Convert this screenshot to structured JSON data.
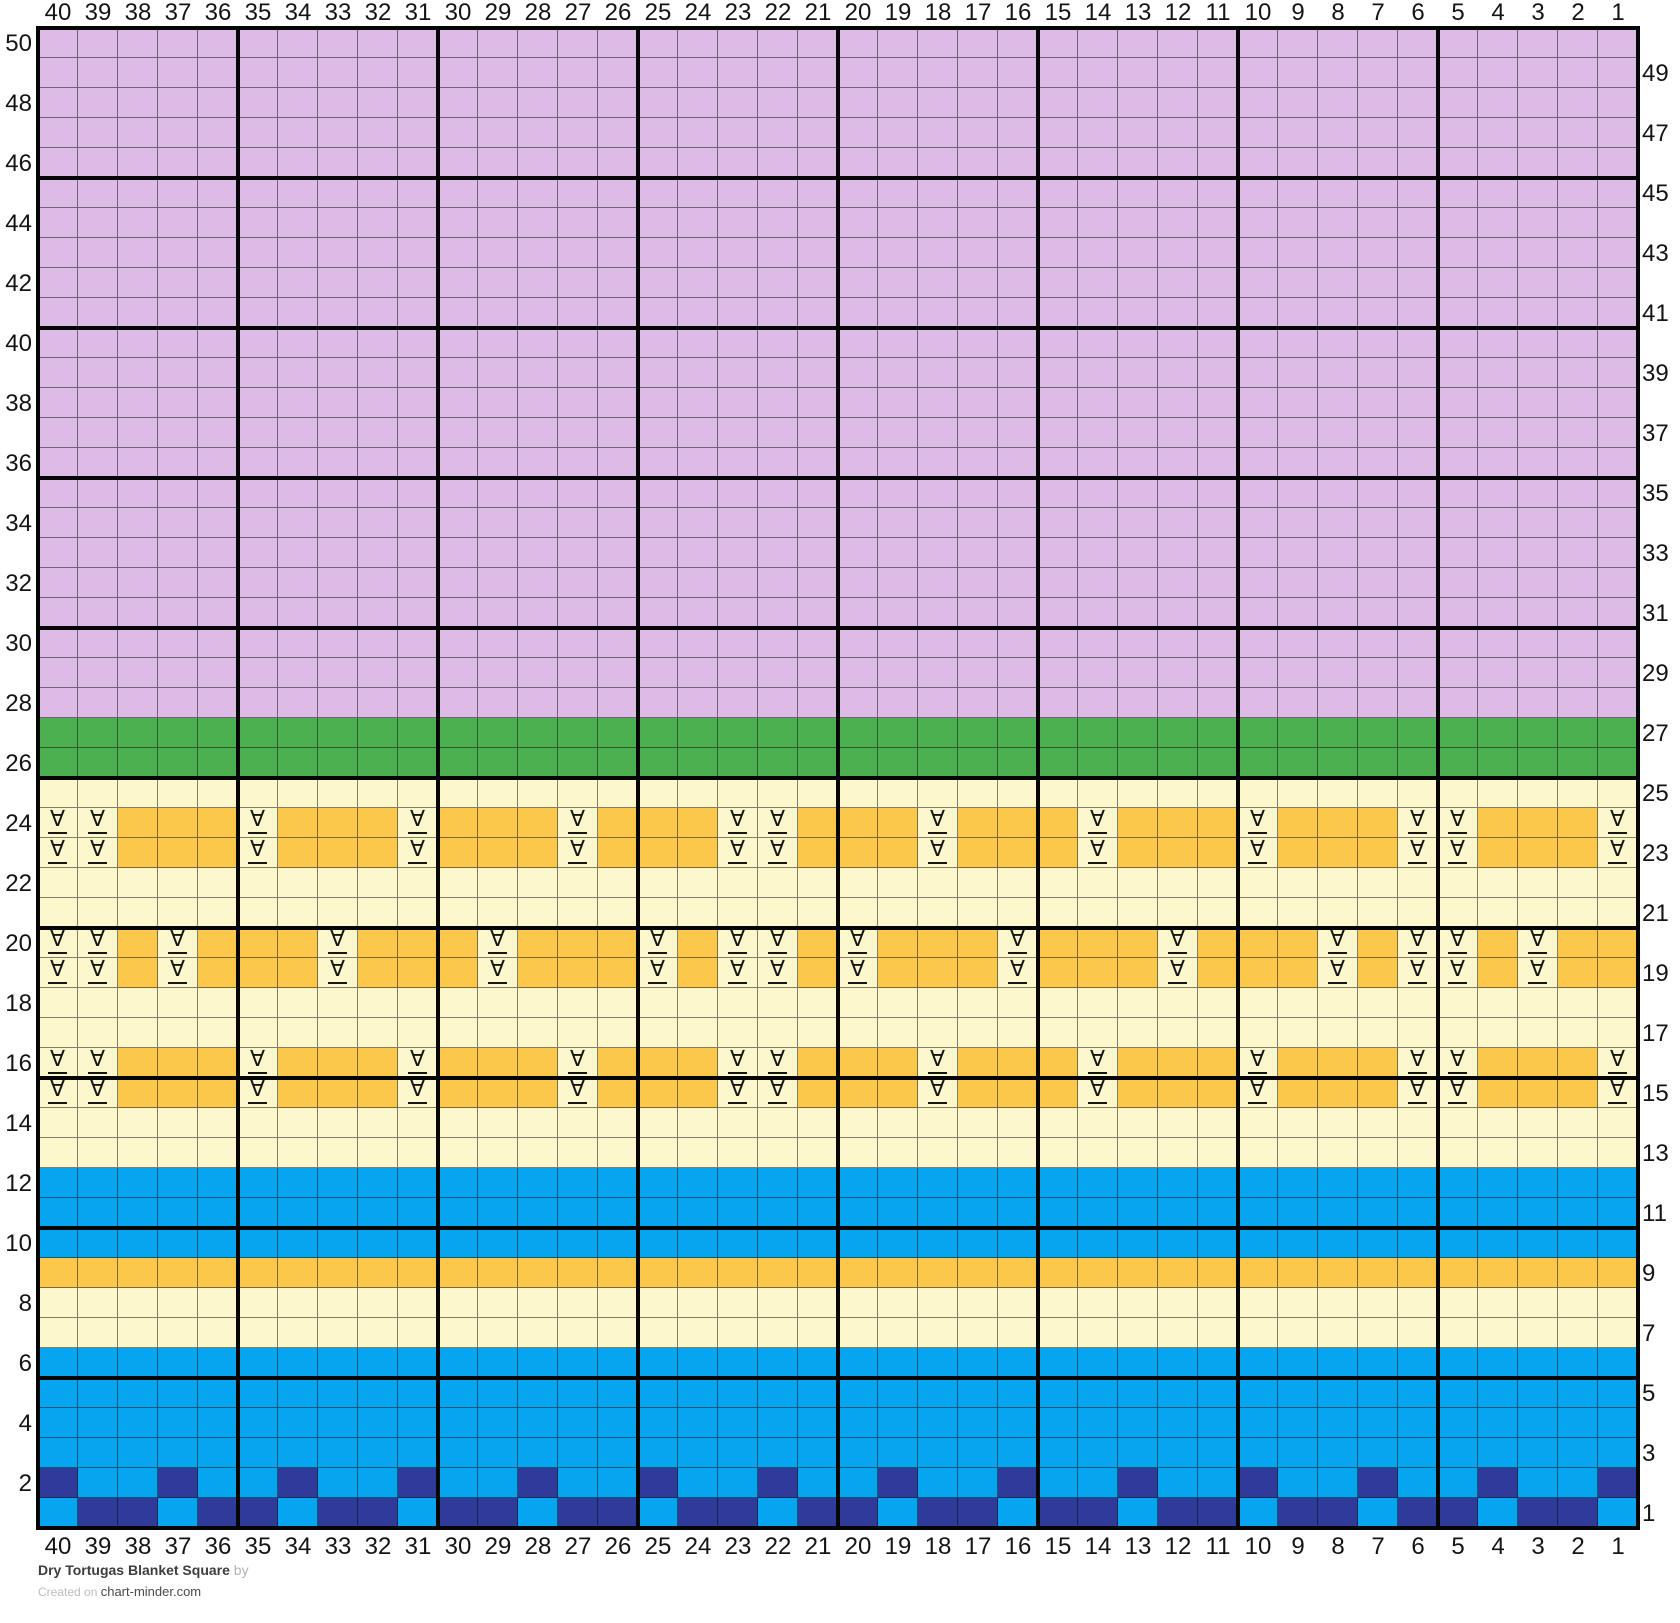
{
  "footer": {
    "title": "Dry Tortugas Blanket Square",
    "byline": "by",
    "created_prefix": "Created on",
    "site": "chart-minder.com"
  },
  "palette": {
    "lavender": "#dcbce6",
    "green": "#4caf50",
    "yellow": "#fdf8cc",
    "orange": "#fcc84c",
    "blue": "#05a5f0",
    "navy": "#2f3b99",
    "symbol_color": "#161616",
    "grid_line": "#060606"
  },
  "grid": {
    "cols": 40,
    "rows": 50,
    "thick_line_every": 5,
    "col_labels": [
      40,
      39,
      38,
      37,
      36,
      35,
      34,
      33,
      32,
      31,
      30,
      29,
      28,
      27,
      26,
      25,
      24,
      23,
      22,
      21,
      20,
      19,
      18,
      17,
      16,
      15,
      14,
      13,
      12,
      11,
      10,
      9,
      8,
      7,
      6,
      5,
      4,
      3,
      2,
      1
    ],
    "left_row_labels": [
      50,
      48,
      46,
      44,
      42,
      40,
      38,
      36,
      34,
      32,
      30,
      28,
      26,
      24,
      22,
      20,
      18,
      16,
      14,
      12,
      10,
      8,
      6,
      4,
      2
    ],
    "right_row_labels": [
      49,
      47,
      45,
      43,
      41,
      39,
      37,
      35,
      33,
      31,
      29,
      27,
      25,
      23,
      21,
      19,
      17,
      15,
      13,
      11,
      9,
      7,
      5,
      3,
      1
    ],
    "symbol": {
      "glyph": "∀"
    },
    "bands": [
      {
        "rows": [
          50,
          28
        ],
        "fill": "lavender"
      },
      {
        "rows": [
          27,
          26
        ],
        "fill": "green"
      },
      {
        "rows": [
          25,
          25
        ],
        "fill": "yellow"
      },
      {
        "rows": [
          24,
          23
        ],
        "fill": "orange",
        "symbol_cell_fill": "yellow",
        "symbol_cols": [
          40,
          39,
          35,
          31,
          27,
          23,
          22,
          18,
          14,
          10,
          6,
          5,
          1
        ]
      },
      {
        "rows": [
          22,
          21
        ],
        "fill": "yellow"
      },
      {
        "rows": [
          20,
          19
        ],
        "fill": "orange",
        "symbol_cell_fill": "yellow",
        "symbol_cols": [
          40,
          39,
          37,
          33,
          29,
          25,
          23,
          22,
          20,
          16,
          12,
          8,
          6,
          5,
          3
        ]
      },
      {
        "rows": [
          18,
          17
        ],
        "fill": "yellow"
      },
      {
        "rows": [
          16,
          15
        ],
        "fill": "orange",
        "symbol_cell_fill": "yellow",
        "symbol_cols": [
          40,
          39,
          35,
          31,
          27,
          23,
          22,
          18,
          14,
          10,
          6,
          5,
          1
        ]
      },
      {
        "rows": [
          14,
          13
        ],
        "fill": "yellow"
      },
      {
        "rows": [
          12,
          10
        ],
        "fill": "blue"
      },
      {
        "rows": [
          9,
          9
        ],
        "fill": "orange"
      },
      {
        "rows": [
          8,
          7
        ],
        "fill": "yellow"
      },
      {
        "rows": [
          6,
          3
        ],
        "fill": "blue"
      },
      {
        "rows": [
          2,
          2
        ],
        "fill": "blue",
        "alt_fill": "navy",
        "alt_cols": [
          40,
          37,
          34,
          31,
          28,
          25,
          22,
          19,
          16,
          13,
          10,
          7,
          4,
          1
        ]
      },
      {
        "rows": [
          1,
          1
        ],
        "fill": "navy",
        "alt_fill": "blue",
        "alt_cols": [
          40,
          37,
          34,
          31,
          28,
          25,
          22,
          19,
          16,
          13,
          10,
          7,
          4,
          1
        ]
      }
    ]
  }
}
